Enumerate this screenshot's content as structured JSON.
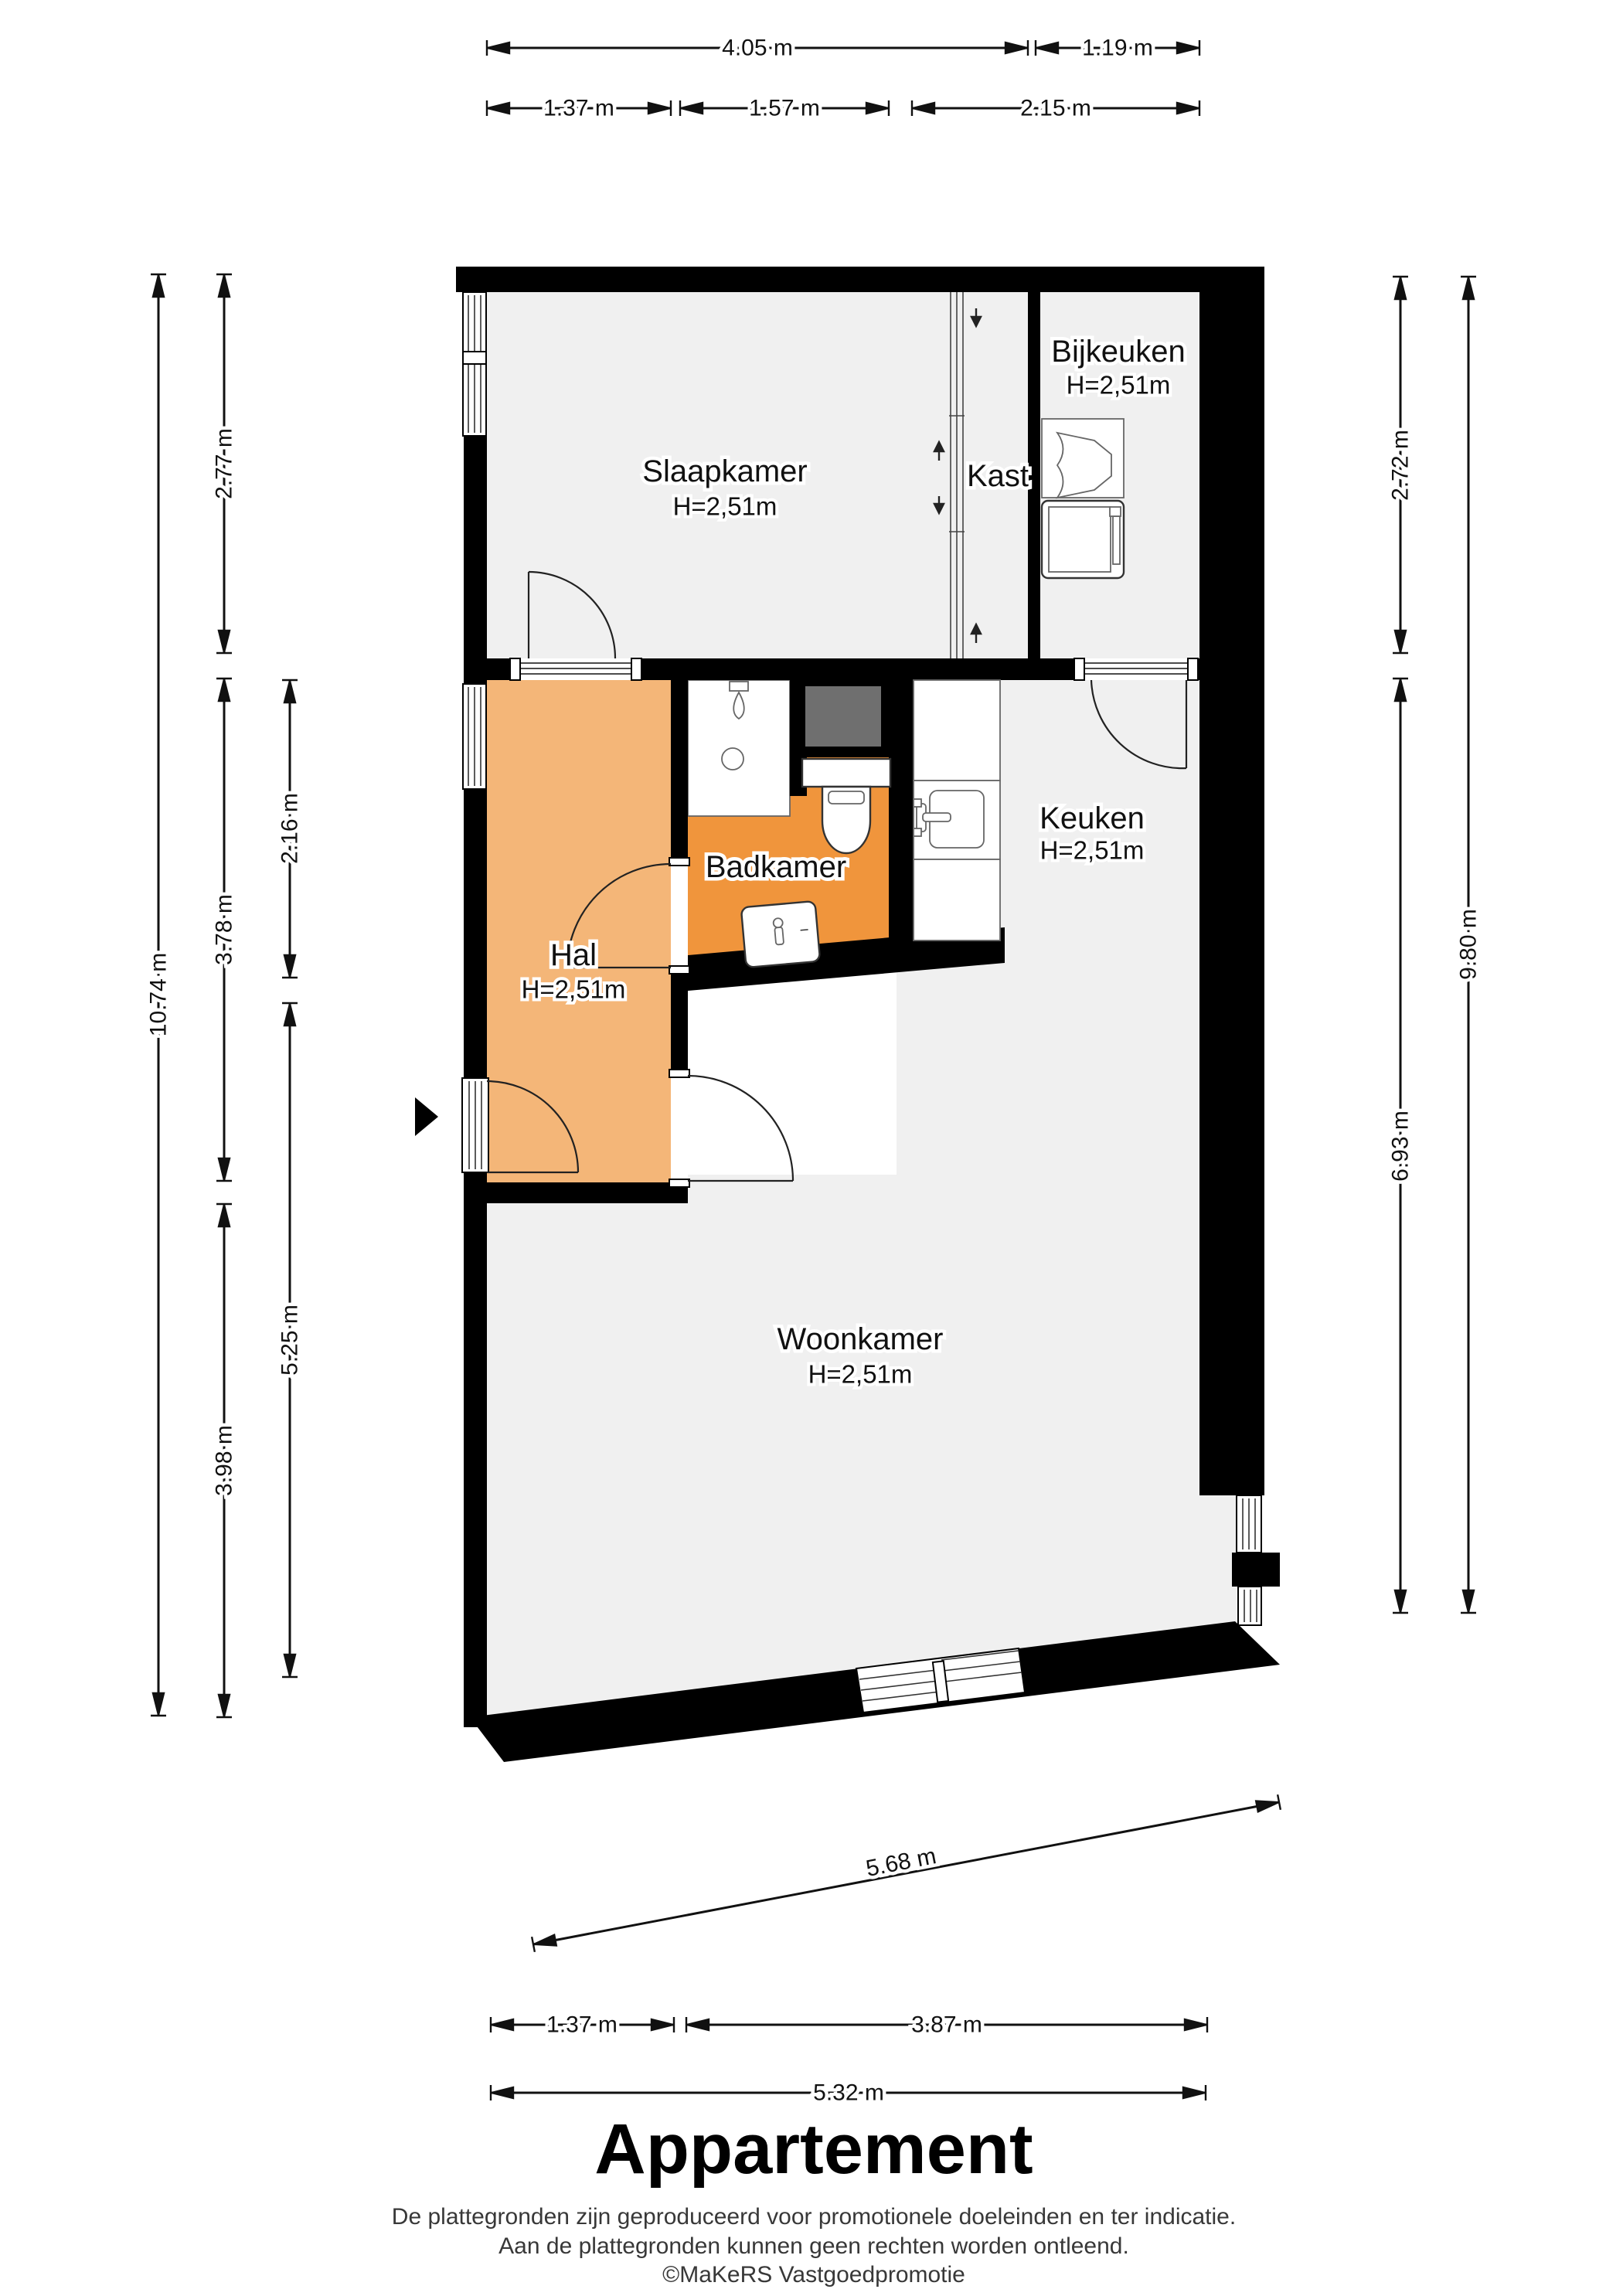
{
  "title": "Appartement",
  "disclaimer": {
    "line1": "De plattegronden zijn geproduceerd voor promotionele doeleinden en ter indicatie.",
    "line2": "Aan de plattegronden kunnen geen rechten worden ontleend.",
    "line3": "©MaKeRS Vastgoedpromotie"
  },
  "rooms": {
    "slaapkamer": {
      "name": "Slaapkamer",
      "ceiling": "H=2,51m"
    },
    "kast": {
      "name": "Kast"
    },
    "bijkeuken": {
      "name": "Bijkeuken",
      "ceiling": "H=2,51m"
    },
    "hal": {
      "name": "Hal",
      "ceiling": "H=2,51m"
    },
    "badkamer": {
      "name": "Badkamer"
    },
    "keuken": {
      "name": "Keuken",
      "ceiling": "H=2,51m"
    },
    "woonkamer": {
      "name": "Woonkamer",
      "ceiling": "H=2,51m"
    }
  },
  "dimensions": {
    "top_row1": [
      "4.05 m",
      "1.19 m"
    ],
    "top_row2": [
      "1.37 m",
      "1.57 m",
      "2.15 m"
    ],
    "left_total": "10.74 m",
    "left_col2": [
      "2.77 m",
      "3.78 m",
      "3.98 m"
    ],
    "left_col3": [
      "2.16 m",
      "5.25 m"
    ],
    "right_col1": [
      "2.72 m",
      "6.93 m"
    ],
    "right_total": "9.80 m",
    "bottom_diag": "5.68 m",
    "bottom_row1": [
      "1.37 m",
      "3.87 m"
    ],
    "bottom_row2": "5.32 m"
  },
  "colors": {
    "wall": "#000000",
    "floor": "#f0f0f0",
    "hal": "#f4b678",
    "badkamer": "#f0953c",
    "shaft": "#6f6f6f"
  }
}
